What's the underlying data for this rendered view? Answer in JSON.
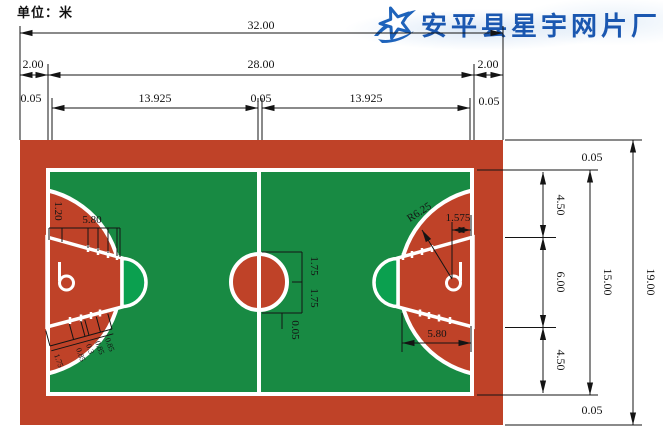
{
  "page": {
    "unit_label": "单位：米"
  },
  "logo": {
    "company": "安平县星宇网片厂",
    "icon": "star-swoosh-icon"
  },
  "colors": {
    "court_red": "#bf4228",
    "field_green": "#188a43",
    "key_green": "#0ba04f",
    "line_white": "#ffffff",
    "dim_black": "#141414",
    "logo_blue": "#1a57b0"
  },
  "dimensions": {
    "top": {
      "total": "32.00",
      "margin_left": "2.00",
      "inner": "28.00",
      "margin_right": "2.00",
      "line_left": "0.05",
      "half_left": "13.925",
      "line_center": "0.05",
      "half_right": "13.925",
      "line_right": "0.05"
    },
    "right": {
      "line_top": "0.05",
      "upper": "4.50",
      "middle": "6.00",
      "lower": "4.50",
      "line_bottom": "0.05",
      "court_width": "15.00",
      "total": "19.00"
    },
    "left_court": {
      "backboard_offset": "1.20",
      "lane_length": "5.80",
      "lane_marks": [
        "1.75",
        "0.85",
        "0.3",
        "0.85",
        "0.85"
      ]
    },
    "center_circle": {
      "radius_upper": "1.75",
      "radius_lower": "1.75",
      "line_width": "0.05"
    },
    "right_court": {
      "three_point_radius": "R6.25",
      "rim_offset": "1.575",
      "lane_length": "5.80"
    }
  }
}
